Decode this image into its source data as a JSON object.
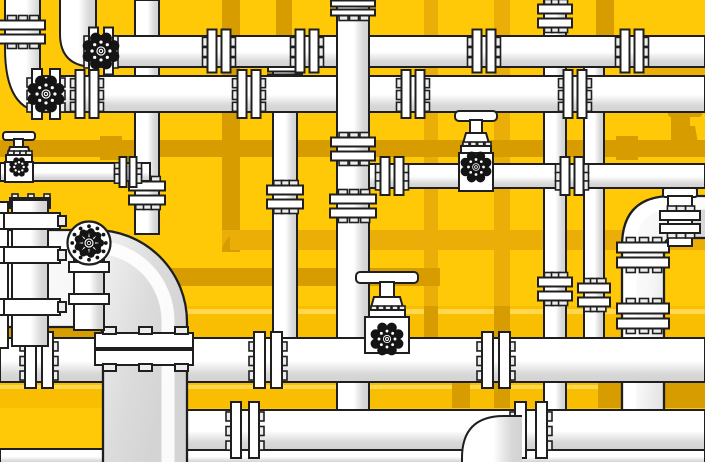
{
  "scene": {
    "width": 705,
    "height": 462,
    "description": "flat vector illustration of industrial pipe network with valves and flanges"
  },
  "palette": {
    "bg": "#FFC907",
    "yellowPipe": "#F9BE02",
    "yellowHi": "#FFD84E",
    "mustard": "#EBAE08",
    "ochre": "#D79C00",
    "white": "#FFFFFF",
    "tab": "#EDEDED",
    "shade": "#D6D6D6",
    "line": "#1F1F1F",
    "valveBlack": "#141414"
  },
  "bg_elements": [
    {
      "name": "bg-pipe-vertical-a",
      "kind": "rect",
      "x": 222,
      "y": 0,
      "w": 18,
      "h": 252,
      "fill": "ochre"
    },
    {
      "name": "bg-pipe-vertical-b",
      "kind": "rect",
      "x": 276,
      "y": 0,
      "w": 16,
      "h": 70,
      "fill": "ochre"
    },
    {
      "name": "bg-pipe-vertical-c",
      "kind": "rect",
      "x": 424,
      "y": 0,
      "w": 14,
      "h": 312,
      "fill": "mustard"
    },
    {
      "name": "bg-pipe-vertical-d",
      "kind": "rect",
      "x": 494,
      "y": 0,
      "w": 16,
      "h": 408,
      "fill": "mustard"
    },
    {
      "name": "bg-pipe-vertical-e",
      "kind": "rect",
      "x": 596,
      "y": 0,
      "w": 18,
      "h": 44,
      "fill": "ochre"
    },
    {
      "name": "bg-pipe-vertical-f",
      "kind": "rect",
      "x": 671,
      "y": 108,
      "w": 17,
      "h": 48,
      "fill": "ochre"
    },
    {
      "name": "bg-elbow-a",
      "kind": "pathF",
      "d": "M222,252 L222,230 L248,230 A26,22 0 0 0 222,252 Z",
      "fill": "mustard"
    },
    {
      "name": "bg-pipe-horizontal-a",
      "kind": "rect",
      "x": 0,
      "y": 140,
      "w": 705,
      "h": 17,
      "fill": "ochre"
    },
    {
      "name": "bg-coupling-a",
      "kind": "rect",
      "x": 100,
      "y": 136,
      "w": 22,
      "h": 24,
      "fill": "ochre"
    },
    {
      "name": "bg-coupling-b",
      "kind": "rect",
      "x": 616,
      "y": 136,
      "w": 22,
      "h": 24,
      "fill": "ochre"
    },
    {
      "name": "bg-pipe-horizontal-b",
      "kind": "rect",
      "x": 230,
      "y": 230,
      "w": 475,
      "h": 20,
      "fill": "mustard"
    },
    {
      "name": "bg-pipe-horizontal-c",
      "kind": "rect",
      "x": 150,
      "y": 268,
      "w": 290,
      "h": 18,
      "fill": "ochre"
    },
    {
      "name": "bg-pipe-horizontal-d",
      "kind": "rect",
      "x": 643,
      "y": 67,
      "w": 62,
      "h": 43,
      "fill": "mustard"
    },
    {
      "name": "bg-valve-handle",
      "kind": "rect",
      "x": 668,
      "y": 110,
      "w": 34,
      "h": 7,
      "rx": 3,
      "fill": "ochre"
    },
    {
      "name": "bg-valve-stem",
      "kind": "rect",
      "x": 680,
      "y": 116,
      "w": 10,
      "h": 10,
      "fill": "ochre"
    },
    {
      "name": "bg-valve-body",
      "kind": "pathF",
      "d": "M675,126 L695,126 L698,143 L672,143 Z",
      "fill": "ochre"
    },
    {
      "name": "yellow-pipe-band-1",
      "kind": "rect",
      "x": 0,
      "y": 306,
      "w": 705,
      "h": 32,
      "fill": "yellowPipe"
    },
    {
      "name": "yellow-pipe-band-1-highlight",
      "kind": "rect",
      "x": 0,
      "y": 309,
      "w": 705,
      "h": 5,
      "fill": "yellowHi"
    },
    {
      "name": "bg-patch-a",
      "kind": "rect",
      "x": 0,
      "y": 318,
      "w": 112,
      "h": 20,
      "fill": "ochre"
    },
    {
      "name": "bg-patch-b",
      "kind": "rect",
      "x": 424,
      "y": 306,
      "w": 14,
      "h": 32,
      "fill": "ochre"
    },
    {
      "name": "bg-patch-c",
      "kind": "rect",
      "x": 494,
      "y": 306,
      "w": 16,
      "h": 32,
      "fill": "ochre"
    },
    {
      "name": "yellow-pipe-band-2",
      "kind": "rect",
      "x": 0,
      "y": 382,
      "w": 705,
      "h": 26,
      "fill": "yellowPipe"
    },
    {
      "name": "yellow-pipe-band-2-highlight",
      "kind": "rect",
      "x": 0,
      "y": 385,
      "w": 705,
      "h": 4,
      "fill": "yellowHi"
    },
    {
      "name": "bg-patch-d",
      "kind": "rect",
      "x": 452,
      "y": 382,
      "w": 18,
      "h": 26,
      "fill": "ochre"
    },
    {
      "name": "bg-patch-e",
      "kind": "rect",
      "x": 494,
      "y": 382,
      "w": 16,
      "h": 26,
      "fill": "ochre"
    },
    {
      "name": "bg-patch-f",
      "kind": "rect",
      "x": 598,
      "y": 382,
      "w": 107,
      "h": 26,
      "fill": "ochre"
    }
  ],
  "fg_elements": [
    {
      "name": "pipe-vertical-1",
      "kind": "pipeV",
      "x": 135,
      "y": 0,
      "w": 24,
      "h": 234
    },
    {
      "name": "coupling-v1",
      "kind": "flangeV",
      "cx": 147,
      "cy": 193,
      "span": 36
    },
    {
      "name": "pipe-h3-left",
      "kind": "pipeH",
      "x": 0,
      "y": 163,
      "w": 150,
      "h": 18
    },
    {
      "name": "union-h3-left",
      "kind": "flangeH",
      "cx": 128,
      "cy": 172,
      "span": 30,
      "pw": 7,
      "gap": 3
    },
    {
      "name": "gate-valve-1-handle",
      "kind": "rect",
      "x": 3,
      "y": 132,
      "w": 32,
      "h": 8,
      "rx": 3,
      "fill": "white",
      "stroke": true
    },
    {
      "name": "gate-valve-1-stem",
      "kind": "rect",
      "x": 14,
      "y": 139,
      "w": 9,
      "h": 9,
      "fill": "white",
      "stroke": true
    },
    {
      "name": "gate-valve-1-bonnet",
      "kind": "pathF",
      "d": "M10,147 L28,147 L31,156 L7,156 Z",
      "fill": "white",
      "stroke": true
    },
    {
      "name": "gate-valve-1-flange",
      "kind": "teeth",
      "x": 6,
      "y": 155,
      "w": 26,
      "h": 8,
      "n": 4
    },
    {
      "name": "gate-valve-1-body",
      "kind": "rect",
      "x": 5,
      "y": 162,
      "w": 28,
      "h": 20,
      "fill": "white",
      "stroke": true
    },
    {
      "name": "gate-valve-1-handwheel-icon",
      "kind": "gear",
      "cx": 19,
      "cy": 167,
      "r": 10
    },
    {
      "name": "pipe-vertical-2",
      "kind": "pipeV",
      "x": 273,
      "y": 60,
      "w": 24,
      "h": 280
    },
    {
      "name": "collar-v2",
      "kind": "flangeV",
      "cx": 285,
      "cy": 73,
      "span": 34,
      "pw": 8,
      "gap": 3
    },
    {
      "name": "coupling-v2",
      "kind": "flangeV",
      "cx": 285,
      "cy": 197,
      "span": 36
    },
    {
      "name": "pipe-vertical-5",
      "kind": "pipeV",
      "x": 544,
      "y": 0,
      "w": 22,
      "h": 412
    },
    {
      "name": "coupling-v5-top",
      "kind": "flangeV",
      "cx": 555,
      "cy": 16,
      "span": 34
    },
    {
      "name": "coupling-v5-mid",
      "kind": "flangeV",
      "cx": 555,
      "cy": 289,
      "span": 34
    },
    {
      "name": "pipe-vertical-6",
      "kind": "pipeV",
      "x": 584,
      "y": 56,
      "w": 20,
      "h": 284
    },
    {
      "name": "coupling-v6",
      "kind": "flangeV",
      "cx": 594,
      "cy": 295,
      "span": 32
    },
    {
      "name": "pipe-right-elbow",
      "kind": "pipeBig",
      "d": "M705,196 L672,196 Q622,196 622,246 L622,412 L664,412 L664,248 Q664,238 674,238 L705,238 Z",
      "outlines": [
        "M705,196 L672,196 Q622,196 622,246 L622,412",
        "M664,412 L664,248 Q664,238 674,238 L705,238"
      ],
      "hi": "M705,203 L674,203 Q630,203 630,248 L630,412"
    },
    {
      "name": "flange-right-elbow-upper",
      "kind": "flangeV",
      "cx": 643,
      "cy": 255,
      "span": 52,
      "pw": 10,
      "gap": 5
    },
    {
      "name": "flange-right-elbow-lower",
      "kind": "flangeV",
      "cx": 643,
      "cy": 316,
      "span": 52,
      "pw": 10,
      "gap": 5
    },
    {
      "name": "stub-cap",
      "kind": "rect",
      "x": 663,
      "y": 188,
      "w": 34,
      "h": 9,
      "rx": 2,
      "fill": "white",
      "stroke": true
    },
    {
      "name": "stub-body",
      "kind": "rect",
      "x": 668,
      "y": 196,
      "w": 24,
      "h": 50,
      "fill": "white",
      "stroke": true
    },
    {
      "name": "stub-flange",
      "kind": "flangeV",
      "cx": 680,
      "cy": 222,
      "span": 40,
      "pw": 9,
      "gap": 4
    },
    {
      "name": "pipe-h2",
      "kind": "pipeH",
      "x": 96,
      "y": 36,
      "w": 609,
      "h": 31
    },
    {
      "name": "elbow-h2",
      "kind": "pathF",
      "d": "M60,0 L96,0 L96,67 L95,67 Q60,67 60,34 Z",
      "fill": "gv",
      "stroke": false
    },
    {
      "name": "elbow-h2-outline-outer",
      "kind": "pathS",
      "d": "M60,0 L60,34 Q60,67 95,67"
    },
    {
      "name": "elbow-h2-outline-inner",
      "kind": "pathS",
      "d": "M96,0 L96,36"
    },
    {
      "name": "valve-2-bracket",
      "kind": "flangeH",
      "cx": 101,
      "cy": 51,
      "span": 47,
      "pw": 9,
      "gap": 6
    },
    {
      "name": "valve-2-handwheel-icon",
      "kind": "gear",
      "cx": 101,
      "cy": 51,
      "r": 19
    },
    {
      "name": "flange-h2-a",
      "kind": "flangeH",
      "cx": 219,
      "cy": 51,
      "span": 43
    },
    {
      "name": "flange-h2-b",
      "kind": "flangeH",
      "cx": 307,
      "cy": 51,
      "span": 43
    },
    {
      "name": "flange-h2-c",
      "kind": "flangeH",
      "cx": 484,
      "cy": 51,
      "span": 43
    },
    {
      "name": "flange-h2-d",
      "kind": "flangeH",
      "cx": 632,
      "cy": 51,
      "span": 43
    },
    {
      "name": "pipe-h1",
      "kind": "pipeH",
      "x": 40,
      "y": 76,
      "w": 665,
      "h": 36
    },
    {
      "name": "elbow-h1",
      "kind": "pathF",
      "d": "M5,0 L40,0 L40,112 L45,112 Q5,112 5,48 Z",
      "fill": "gv",
      "stroke": false
    },
    {
      "name": "elbow-h1-outline-outer",
      "kind": "pathS",
      "d": "M5,0 L5,48 Q5,112 45,112"
    },
    {
      "name": "elbow-h1-outline-inner",
      "kind": "pathS",
      "d": "M40,0 L40,76"
    },
    {
      "name": "flange-elbow-h1",
      "kind": "flangeV",
      "cx": 22,
      "cy": 32,
      "span": 46
    },
    {
      "name": "valve-1-bracket",
      "kind": "flangeH",
      "cx": 46,
      "cy": 94,
      "span": 50,
      "pw": 10,
      "gap": 8
    },
    {
      "name": "valve-1-handwheel-icon",
      "kind": "gear",
      "cx": 46,
      "cy": 94,
      "r": 19
    },
    {
      "name": "flange-h1-a",
      "kind": "flangeH",
      "cx": 87,
      "cy": 94,
      "span": 48
    },
    {
      "name": "flange-h1-b",
      "kind": "flangeH",
      "cx": 249,
      "cy": 94,
      "span": 48
    },
    {
      "name": "flange-h1-c",
      "kind": "flangeH",
      "cx": 413,
      "cy": 94,
      "span": 48
    },
    {
      "name": "flange-h1-d",
      "kind": "flangeH",
      "cx": 575,
      "cy": 94,
      "span": 48
    },
    {
      "name": "pipe-h3-right",
      "kind": "pipeH",
      "x": 352,
      "y": 164,
      "w": 353,
      "h": 24
    },
    {
      "name": "flange-h3r-tee",
      "kind": "flangeH",
      "cx": 392,
      "cy": 176,
      "span": 38
    },
    {
      "name": "flange-h3r-b",
      "kind": "flangeH",
      "cx": 572,
      "cy": 176,
      "span": 38
    },
    {
      "name": "gate-valve-4-handle",
      "kind": "rect",
      "x": 455,
      "y": 111,
      "w": 42,
      "h": 10,
      "rx": 4,
      "fill": "white",
      "stroke": true
    },
    {
      "name": "gate-valve-4-stem",
      "kind": "rect",
      "x": 470,
      "y": 120,
      "w": 12,
      "h": 14,
      "fill": "white",
      "stroke": true
    },
    {
      "name": "gate-valve-4-bonnet",
      "kind": "pathF",
      "d": "M466,133 L486,133 L490,147 L462,147 Z",
      "fill": "white",
      "stroke": true
    },
    {
      "name": "gate-valve-4-flange",
      "kind": "teeth",
      "x": 461,
      "y": 146,
      "w": 30,
      "h": 8,
      "n": 4
    },
    {
      "name": "gate-valve-4-body",
      "kind": "rect",
      "x": 459,
      "y": 153,
      "w": 34,
      "h": 38,
      "fill": "white",
      "stroke": true
    },
    {
      "name": "gate-valve-4-handwheel-icon",
      "kind": "gear",
      "cx": 476,
      "cy": 167,
      "r": 16
    },
    {
      "name": "pipe-vertical-3",
      "kind": "pipeV",
      "x": 337,
      "y": 0,
      "w": 32,
      "h": 450
    },
    {
      "name": "cap-v3",
      "kind": "flangeV",
      "cx": 353,
      "cy": 8,
      "span": 44,
      "pw": 6,
      "gap": 3
    },
    {
      "name": "coupling-v3-upper",
      "kind": "flangeV",
      "cx": 353,
      "cy": 149,
      "span": 44
    },
    {
      "name": "coupling-v3-lower",
      "kind": "flangeV",
      "cx": 353,
      "cy": 206,
      "span": 46
    },
    {
      "name": "pipe-bottom-1",
      "kind": "pipeH",
      "x": 0,
      "y": 338,
      "w": 705,
      "h": 44
    },
    {
      "name": "flange-pb1-a",
      "kind": "flangeH",
      "cx": 39,
      "cy": 360,
      "span": 56,
      "pw": 11,
      "gap": 6
    },
    {
      "name": "flange-pb1-b",
      "kind": "flangeH",
      "cx": 268,
      "cy": 360,
      "span": 56,
      "pw": 11,
      "gap": 6
    },
    {
      "name": "flange-pb1-c",
      "kind": "flangeH",
      "cx": 496,
      "cy": 360,
      "span": 56,
      "pw": 11,
      "gap": 6
    },
    {
      "name": "gate-valve-5-handle",
      "kind": "rect",
      "x": 356,
      "y": 272,
      "w": 62,
      "h": 11,
      "rx": 4,
      "fill": "white",
      "stroke": true
    },
    {
      "name": "gate-valve-5-stem",
      "kind": "rect",
      "x": 380,
      "y": 282,
      "w": 14,
      "h": 16,
      "fill": "white",
      "stroke": true
    },
    {
      "name": "gate-valve-5-bonnet",
      "kind": "pathF",
      "d": "M374,297 L400,297 L404,311 L370,311 Z",
      "fill": "white",
      "stroke": true
    },
    {
      "name": "gate-valve-5-flange",
      "kind": "teeth",
      "x": 369,
      "y": 310,
      "w": 36,
      "h": 8,
      "n": 5
    },
    {
      "name": "gate-valve-5-body",
      "kind": "rect",
      "x": 365,
      "y": 317,
      "w": 44,
      "h": 36,
      "fill": "white",
      "stroke": true
    },
    {
      "name": "gate-valve-5-handwheel-icon",
      "kind": "gear",
      "cx": 387,
      "cy": 339,
      "r": 17
    },
    {
      "name": "pipe-bottom-3",
      "kind": "pipeH",
      "x": 0,
      "y": 449,
      "w": 705,
      "h": 15
    },
    {
      "name": "pipe-bottom-2",
      "kind": "pipeH",
      "x": 185,
      "y": 410,
      "w": 520,
      "h": 40
    },
    {
      "name": "flange-pb2-end",
      "kind": "flangeH",
      "cx": 245,
      "cy": 430,
      "span": 56,
      "pw": 10,
      "gap": 8
    },
    {
      "name": "flange-pb2-b",
      "kind": "flangeH",
      "cx": 531,
      "cy": 430,
      "span": 56,
      "pw": 11,
      "gap": 10
    },
    {
      "name": "elbow-bottom",
      "kind": "pathF",
      "d": "M462,462 L462,458 Q462,416 504,416 L522,416 L522,462 Z",
      "fill": "gv",
      "stroke": false
    },
    {
      "name": "elbow-bottom-outline",
      "kind": "pathS",
      "d": "M462,462 L462,458 Q462,416 504,416 L522,416"
    },
    {
      "name": "big-elbow",
      "kind": "pipeBig",
      "d": "M0,230 L95,230 A92,92 0 0 1 187,322 L187,462 L103,462 L103,336 Q103,327 93,327 L0,327 Z",
      "outlines": [
        "M0,230 L95,230 A92,92 0 0 1 187,322 L187,462",
        "M103,462 L103,336 Q103,327 93,327 L0,327"
      ],
      "hi": "M0,247 L94,247 A74,74 0 0 1 168,321 L168,462"
    },
    {
      "name": "big-flange-joint-plate-top",
      "kind": "rect",
      "x": 95,
      "y": 333,
      "w": 98,
      "h": 15,
      "fill": "white",
      "stroke": true
    },
    {
      "name": "big-flange-joint-plate-bottom",
      "kind": "rect",
      "x": 95,
      "y": 350,
      "w": 98,
      "h": 15,
      "fill": "white",
      "stroke": true
    },
    {
      "name": "big-joint-bolt-a",
      "kind": "rect",
      "x": 103,
      "y": 327,
      "w": 13,
      "h": 7,
      "fill": "tab",
      "stroke": true
    },
    {
      "name": "big-joint-bolt-b",
      "kind": "rect",
      "x": 139,
      "y": 327,
      "w": 13,
      "h": 7,
      "fill": "tab",
      "stroke": true
    },
    {
      "name": "big-joint-bolt-c",
      "kind": "rect",
      "x": 175,
      "y": 327,
      "w": 13,
      "h": 7,
      "fill": "tab",
      "stroke": true
    },
    {
      "name": "big-joint-bolt-d",
      "kind": "rect",
      "x": 103,
      "y": 364,
      "w": 13,
      "h": 7,
      "fill": "tab",
      "stroke": true
    },
    {
      "name": "big-joint-bolt-e",
      "kind": "rect",
      "x": 139,
      "y": 364,
      "w": 13,
      "h": 7,
      "fill": "tab",
      "stroke": true
    },
    {
      "name": "big-joint-bolt-f",
      "kind": "rect",
      "x": 175,
      "y": 364,
      "w": 13,
      "h": 7,
      "fill": "tab",
      "stroke": true
    },
    {
      "name": "column-a",
      "kind": "rect",
      "x": -12,
      "y": 202,
      "w": 20,
      "h": 146,
      "fill": "white",
      "stroke": true
    },
    {
      "name": "column-a-ring-1",
      "kind": "rect",
      "x": -12,
      "y": 213,
      "w": 26,
      "h": 16,
      "fill": "white",
      "stroke": true
    },
    {
      "name": "column-a-ring-2",
      "kind": "rect",
      "x": -12,
      "y": 247,
      "w": 26,
      "h": 16,
      "fill": "white",
      "stroke": true
    },
    {
      "name": "column-a-ring-3",
      "kind": "rect",
      "x": -12,
      "y": 299,
      "w": 26,
      "h": 16,
      "fill": "white",
      "stroke": true
    },
    {
      "name": "column-b-cap",
      "kind": "teeth",
      "x": 10,
      "y": 198,
      "w": 40,
      "h": 10,
      "n": 3
    },
    {
      "name": "column-b",
      "kind": "pipeV",
      "x": 12,
      "y": 200,
      "w": 36,
      "h": 146
    },
    {
      "name": "column-b-ring-1",
      "kind": "rect",
      "x": 4,
      "y": 213,
      "w": 56,
      "h": 16,
      "fill": "white",
      "stroke": true
    },
    {
      "name": "column-b-ring-1-tab",
      "kind": "rect",
      "x": 58,
      "y": 216,
      "w": 8,
      "h": 10,
      "fill": "tab",
      "stroke": true
    },
    {
      "name": "column-b-ring-2",
      "kind": "rect",
      "x": 4,
      "y": 247,
      "w": 56,
      "h": 16,
      "fill": "white",
      "stroke": true
    },
    {
      "name": "column-b-ring-2-tab",
      "kind": "rect",
      "x": 58,
      "y": 250,
      "w": 8,
      "h": 10,
      "fill": "tab",
      "stroke": true
    },
    {
      "name": "column-b-ring-3",
      "kind": "rect",
      "x": 4,
      "y": 299,
      "w": 56,
      "h": 16,
      "fill": "white",
      "stroke": true
    },
    {
      "name": "column-b-ring-3-tab",
      "kind": "rect",
      "x": 58,
      "y": 302,
      "w": 8,
      "h": 10,
      "fill": "tab",
      "stroke": true
    },
    {
      "name": "disc-bracket",
      "kind": "pipeV",
      "x": 74,
      "y": 260,
      "w": 30,
      "h": 70
    },
    {
      "name": "disc-bracket-bar-1",
      "kind": "rect",
      "x": 69,
      "y": 262,
      "w": 40,
      "h": 10,
      "fill": "white",
      "stroke": true
    },
    {
      "name": "disc-bracket-bar-2",
      "kind": "rect",
      "x": 69,
      "y": 294,
      "w": 40,
      "h": 10,
      "fill": "white",
      "stroke": true
    },
    {
      "name": "big-flange-disc-handwheel-icon",
      "kind": "disc",
      "cx": 89,
      "cy": 243,
      "r": 21.5
    }
  ]
}
